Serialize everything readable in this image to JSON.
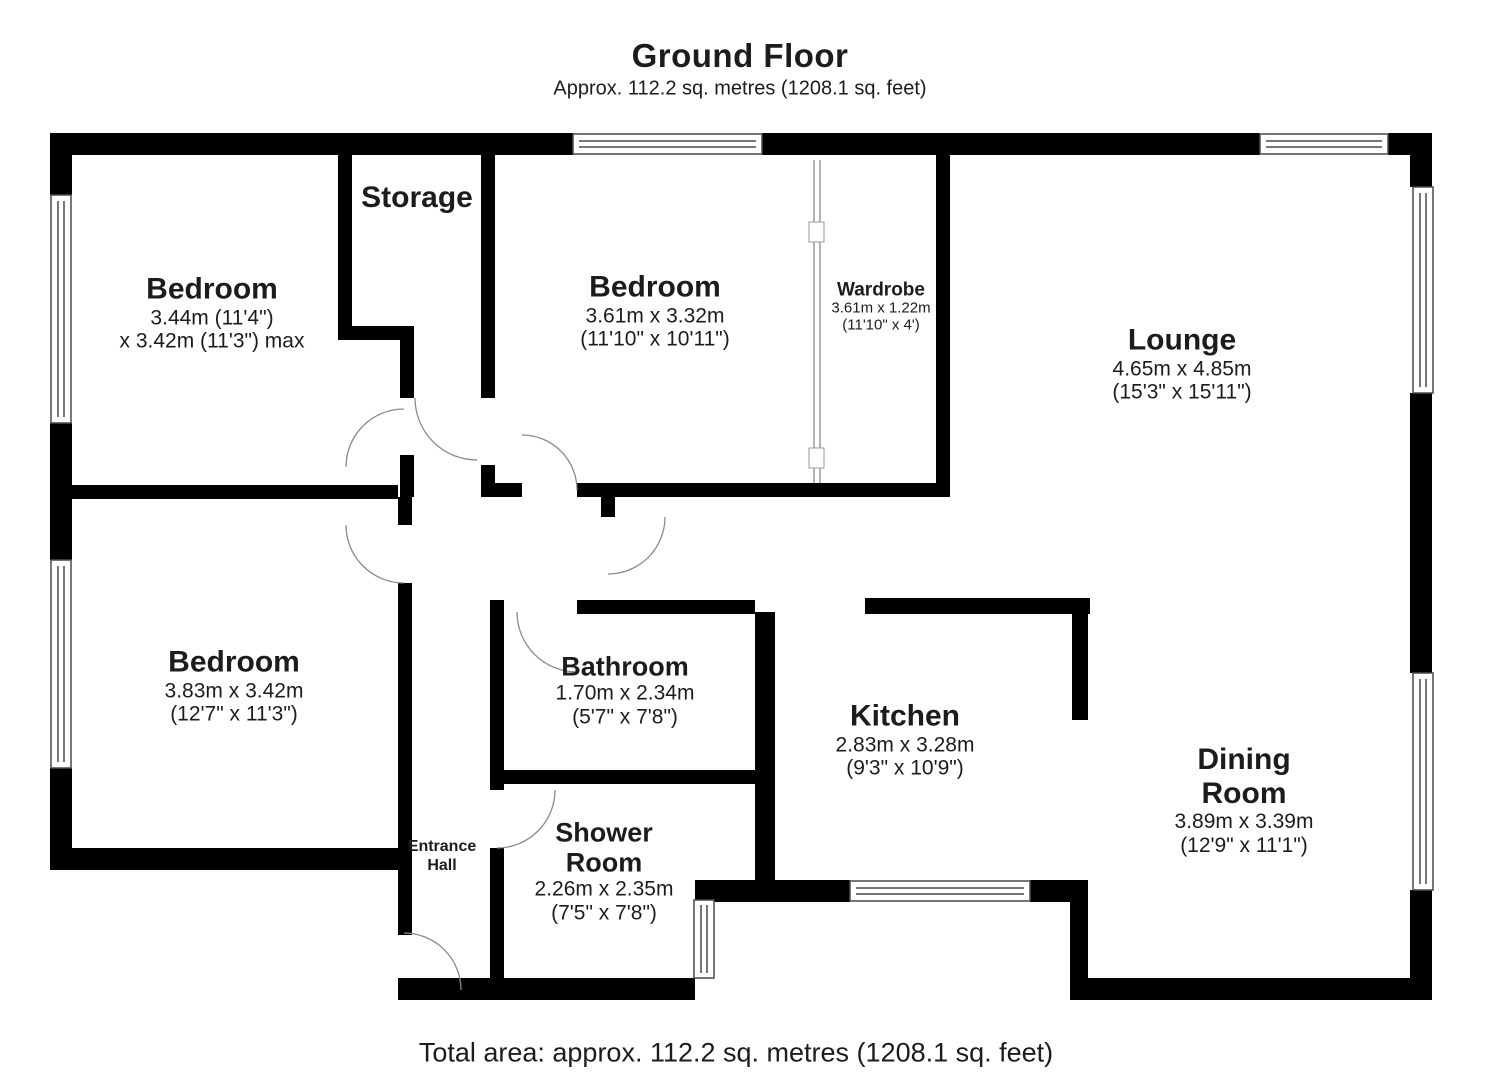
{
  "title": "Ground Floor",
  "subtitle": "Approx. 112.2 sq. metres (1208.1 sq. feet)",
  "footer": "Total area: approx. 112.2 sq. metres (1208.1 sq. feet)",
  "rooms": {
    "bedroom_top_left": {
      "name": "Bedroom",
      "dim1": "3.44m (11'4\")",
      "dim2": "x 3.42m (11'3\") max"
    },
    "storage": {
      "name": "Storage"
    },
    "bedroom_top_middle": {
      "name": "Bedroom",
      "dim1": "3.61m x 3.32m",
      "dim2": "(11'10\" x 10'11\")"
    },
    "wardrobe": {
      "name": "Wardrobe",
      "dim1": "3.61m x 1.22m",
      "dim2": "(11'10\" x 4')"
    },
    "lounge": {
      "name": "Lounge",
      "dim1": "4.65m x 4.85m",
      "dim2": "(15'3\" x 15'11\")"
    },
    "bedroom_bottom_left": {
      "name": "Bedroom",
      "dim1": "3.83m x 3.42m",
      "dim2": "(12'7\" x 11'3\")"
    },
    "bathroom": {
      "name": "Bathroom",
      "dim1": "1.70m x 2.34m",
      "dim2": "(5'7\" x 7'8\")"
    },
    "kitchen": {
      "name": "Kitchen",
      "dim1": "2.83m x 3.28m",
      "dim2": "(9'3\" x 10'9\")"
    },
    "dining_room": {
      "name": "Dining",
      "name2": "Room",
      "dim1": "3.89m x 3.39m",
      "dim2": "(12'9\" x 11'1\")"
    },
    "shower_room": {
      "name": "Shower",
      "name2": "Room",
      "dim1": "2.26m x 2.35m",
      "dim2": "(7'5\" x 7'8\")"
    },
    "entrance_hall": {
      "name": "Entrance",
      "name2": "Hall"
    }
  },
  "colors": {
    "wall": "#000000",
    "window_outline": "#4a4a4a",
    "door_arc": "#8a8a8a",
    "text": "#1c1c1c"
  }
}
